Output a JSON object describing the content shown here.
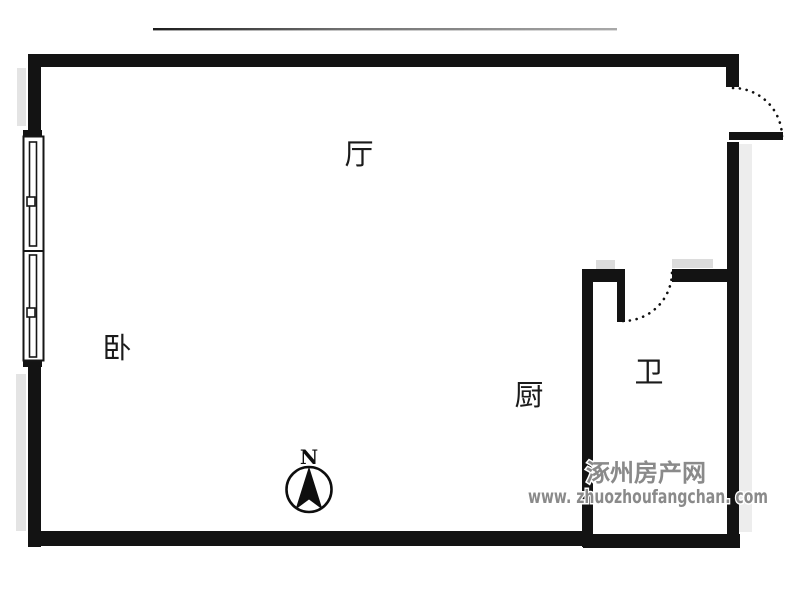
{
  "image": {
    "type": "apartment-floor-plan",
    "background": "#ffffff"
  },
  "colors": {
    "wall": "#131313",
    "wall_shadow": "#e4e4e4",
    "dimension_line_dark": "#1c1c1c",
    "dimension_line_light": "#a9a9a9",
    "watermark_gray": "#8a8a8a"
  },
  "rooms": {
    "living": {
      "label": "厅"
    },
    "bedroom": {
      "label": "卧"
    },
    "kitchen": {
      "label": "厨"
    },
    "bathroom": {
      "label": "卫"
    }
  },
  "compass": {
    "north_label": "N"
  },
  "watermark": {
    "site_name": "涿州房产网",
    "site_url": "www. zhuozhoufangchan. com"
  }
}
